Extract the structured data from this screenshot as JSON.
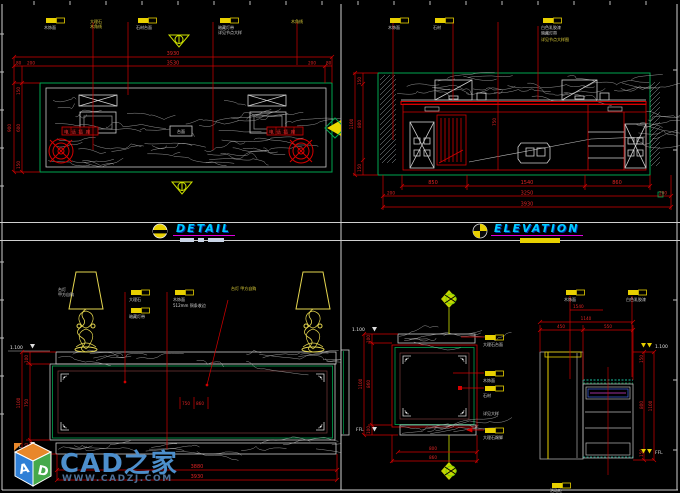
{
  "title_band": {
    "detail": "DETAIL",
    "elevation": "ELEVATION"
  },
  "logo": {
    "brand": "CAD之家",
    "site": "WWW.CADZJ.COM",
    "cube_a": "A",
    "cube_d": "D"
  },
  "q1": {
    "ann": [
      "木饰面",
      "大理石",
      "石材台面",
      "暗藏灯带",
      "详见节点大样",
      "木角线"
    ],
    "dims": {
      "total": "3930",
      "inner": "3530",
      "l1": "80",
      "l2": "200",
      "r1": "200",
      "r2": "80",
      "vt": "900",
      "v1": "150",
      "v2": "600",
      "v3": "150"
    },
    "boxes": {
      "left": "电话插座",
      "center": "台面",
      "right": "电话插座"
    }
  },
  "q2": {
    "ann": [
      "木饰面",
      "石材",
      "白色乳胶漆",
      "暗藏灯带",
      "详见节点大样图"
    ],
    "dims": {
      "b1": "850",
      "b2": "1540",
      "b3": "860",
      "t1": "3250",
      "t2": "3930",
      "bl": "200",
      "br": "200",
      "v1": "150",
      "v2": "800",
      "v3": "150",
      "vt": "1100",
      "c1": "750"
    }
  },
  "q3": {
    "ann": [
      "台灯",
      "甲方自购",
      "大理石",
      "木饰面",
      "512mm 铜条收边",
      "暗藏灯带",
      "台灯 甲方自购"
    ],
    "dims": {
      "vt": "1100",
      "v1": "100",
      "v2": "750",
      "v3": "100",
      "m1": "750",
      "m2": "860",
      "b1": "3880",
      "b2": "3930"
    },
    "levels": {
      "top": "1.100",
      "bottom": "FFL"
    }
  },
  "q4": {
    "ann": [
      "大理石台面",
      "木饰面",
      "石材",
      "详见大样",
      "大理石踢脚",
      "木饰面",
      "白色乳胶漆",
      "活动柜"
    ],
    "dims": {
      "lvt": "1100",
      "lv1": "100",
      "lv2": "860",
      "lv3": "100",
      "b1": "800",
      "b2": "860",
      "t1": "450",
      "t2": "550",
      "tt": "1140",
      "c1": "1540",
      "rv1": "150",
      "rv2": "800",
      "rv3": "150",
      "rvt": "1100"
    },
    "levels": {
      "top": "1.100",
      "bottom": "FFL",
      "rtop": "1.100",
      "rbottom": "FFL"
    }
  }
}
